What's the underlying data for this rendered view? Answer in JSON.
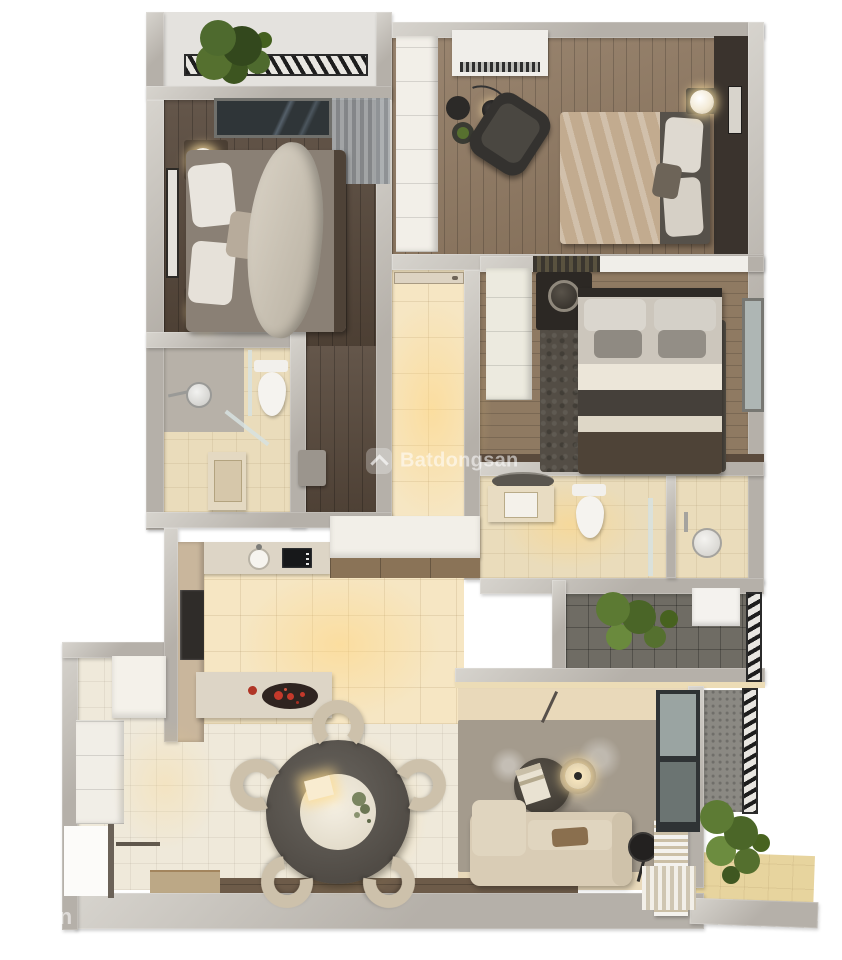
{
  "scene": {
    "type": "3d-apartment-floor-plan-render",
    "width": 842,
    "height": 960
  },
  "watermarks": {
    "center": {
      "icon": "batdongsan-logo",
      "text": "Batdongsan"
    },
    "corner": {
      "text": "ongsan"
    }
  },
  "palette": {
    "wall": "#b5b0a9",
    "walledge": "#d7d4ce",
    "wooddark": "#57483b",
    "woodmid": "#8f7860",
    "wood3": "#8f7a62",
    "tilewarm": "#f6e6c3",
    "tilecream": "#efe9da",
    "tilebath": "#eadcbb",
    "balconytile": "#6f6c64",
    "deck": "#6d5b49",
    "rugliving": "#a49b8d",
    "rugbed": "#534d45",
    "sofa": "#d9ccb5",
    "chair": "#cdc1ab",
    "tabledark": "#5b5650",
    "whitefurn": "#f2efe8",
    "black": "#262422",
    "glassc": "#9aa4a2",
    "curtain": "#a9adb0",
    "duvet": "#d8d1c4",
    "blanket1": "#8a8075",
    "blanket2": "#c2ab8f",
    "mattress": "#56514a",
    "plant": "#4e6a2e",
    "plantdark": "#33481d",
    "red": "#c4392b",
    "glow": "rgba(255,214,130,0.55)",
    "wm": "rgba(255,255,255,0.55)"
  },
  "rooms": [
    {
      "name": "balcony-top",
      "furniture": [
        "plant",
        "metal-railing"
      ]
    },
    {
      "name": "bedroom-1",
      "furniture": [
        "double-bed",
        "pillows",
        "duvet",
        "nightstand-lamp-top",
        "nightstand-lamp-bottom",
        "wall-mirror-panel",
        "window",
        "sheer-curtain",
        "closet-dresser"
      ]
    },
    {
      "name": "bedroom-2",
      "furniture": [
        "wardrobe",
        "ac-unit",
        "lounge-armchair",
        "arc-floor-lamp",
        "side-table",
        "plant-table",
        "double-bed",
        "pillows",
        "nightstand-lamp",
        "headboard-wall-art"
      ]
    },
    {
      "name": "bedroom-3",
      "furniture": [
        "wardrobe",
        "vanity-desk",
        "round-mirror",
        "double-bed",
        "pillows",
        "area-rug",
        "window"
      ]
    },
    {
      "name": "bathroom-1",
      "furniture": [
        "shower-head",
        "glass-screen",
        "toilet",
        "vanity-sink"
      ]
    },
    {
      "name": "bathroom-2",
      "furniture": [
        "round-mirror",
        "vanity-sink",
        "toilet",
        "glass-door",
        "shower-head"
      ]
    },
    {
      "name": "hallway",
      "furniture": [
        "entry-door"
      ]
    },
    {
      "name": "kitchen",
      "furniture": [
        "upper-cabinets",
        "counter",
        "sink",
        "cooktop",
        "fridge",
        "island-counter",
        "serving-tray-red-food"
      ]
    },
    {
      "name": "dining",
      "furniture": [
        "round-table",
        "centerpiece-plate",
        "flowers",
        "chair-1",
        "chair-2",
        "chair-3",
        "chair-4",
        "chair-5"
      ]
    },
    {
      "name": "living-room",
      "furniture": [
        "textured-rug",
        "coffee-table-dark",
        "magazine",
        "coffee-table-lamp",
        "sofa",
        "lumbar-cushion",
        "floor-lamp",
        "slatted-bench"
      ]
    },
    {
      "name": "balcony-mid",
      "furniture": [
        "plant",
        "white-cabinet",
        "metal-railing"
      ]
    },
    {
      "name": "balcony-right",
      "furniture": [
        "window-frames",
        "plant",
        "metal-railing",
        "tile-floor"
      ]
    },
    {
      "name": "entrance",
      "furniture": [
        "upper-cabinet",
        "lower-cabinet",
        "door",
        "coat-rail",
        "wood-deck"
      ]
    }
  ]
}
